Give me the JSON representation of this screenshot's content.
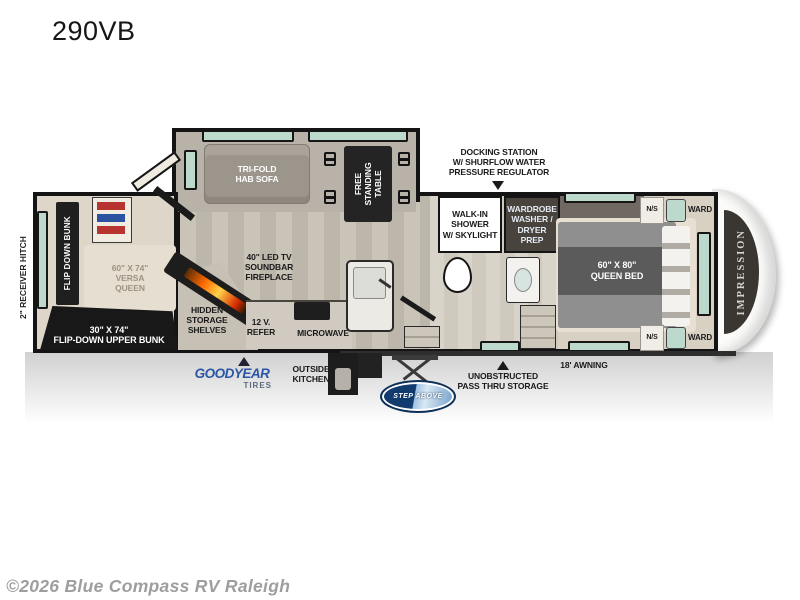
{
  "title": "290VB",
  "footer": "©2026 Blue Compass RV Raleigh",
  "brand": {
    "front_cap": "IMPRESSION",
    "tires_logo": "GOODYEAR",
    "tires_sub": "TIRES",
    "steps_logo": "STEP ABOVE"
  },
  "exterior_labels": {
    "receiver_hitch": "2\" RECEIVER HITCH",
    "docking_station": "DOCKING STATION\nW/ SHURFLOW WATER\nPRESSURE REGULATOR",
    "outside_kitchen": "OUTSIDE\nKITCHEN",
    "pass_thru": "UNOBSTRUCTED\nPASS THRU STORAGE",
    "awning": "18' AWNING"
  },
  "rooms": {
    "bunk_room": {
      "flip_down_bunk": "FLIP DOWN BUNK",
      "versa_queen": "60\" X 74\"\nVERSA\nQUEEN",
      "upper_bunk": "30\" X 74\"\nFLIP-DOWN UPPER BUNK"
    },
    "living": {
      "sofa": "TRI-FOLD\nHAB SOFA",
      "table": "FREE\nSTANDING\nTABLE"
    },
    "kitchen": {
      "tv": "40\" LED TV\nSOUNDBAR\nFIREPLACE",
      "hidden_storage": "HIDDEN\nSTORAGE\nSHELVES",
      "refer": "12 V.\nREFER",
      "microwave": "MICROWAVE"
    },
    "bath": {
      "shower": "WALK-IN\nSHOWER\nW/ SKYLIGHT",
      "wardrobe": "WARDROBE\nWASHER /\nDRYER PREP"
    },
    "bedroom": {
      "bed": "60\" X 80\"\nQUEEN BED",
      "ns_top": "N/S",
      "ns_bottom": "N/S",
      "ward_top": "WARD",
      "ward_bottom": "WARD"
    }
  },
  "colors": {
    "wall": "#141414",
    "window_teal": "#bcd9cb",
    "goodyear_blue": "#2a56a5",
    "stepabove_blue": "#123c6e",
    "flame_orange": "#ff6a00",
    "footer_gray": "#9e9e9e"
  }
}
